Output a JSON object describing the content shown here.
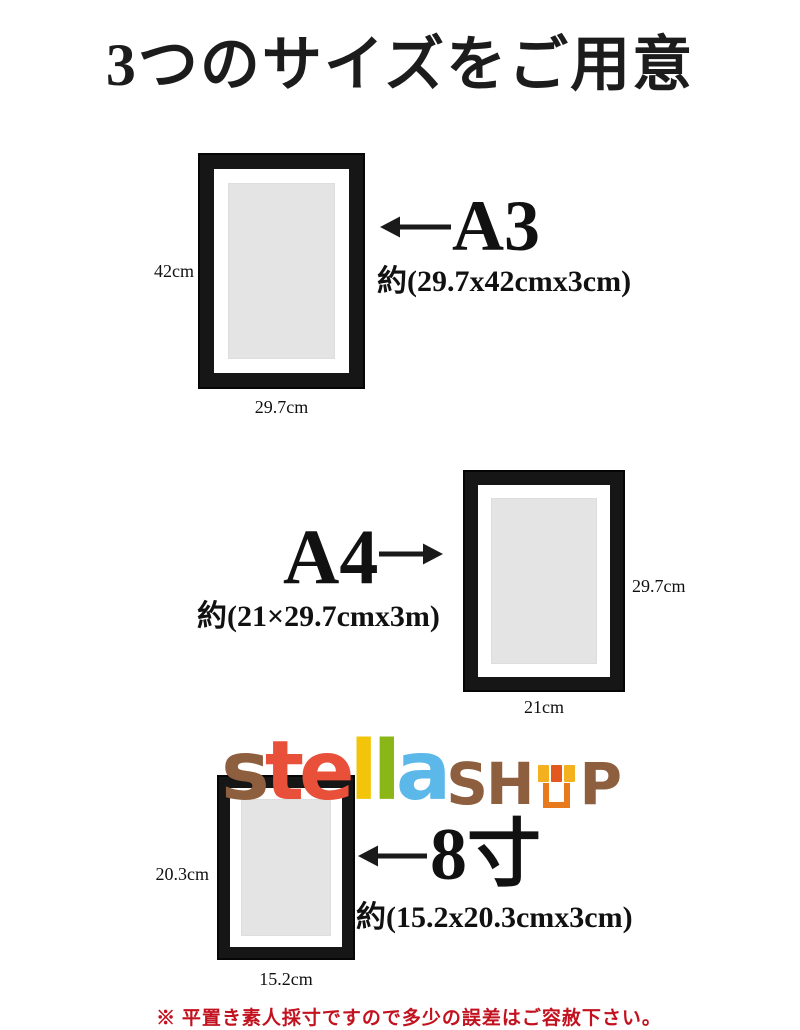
{
  "title": "3つのサイズをご用意",
  "sizes": [
    {
      "id": "a3",
      "name": "A3",
      "approx": "約(29.7x42cmx3cm)",
      "side_label": "42cm",
      "bottom_label": "29.7cm",
      "arrow_direction": "left"
    },
    {
      "id": "a4",
      "name": "A4",
      "approx": "約(21×29.7cmx3m)",
      "side_label": "29.7cm",
      "bottom_label": "21cm",
      "arrow_direction": "right"
    },
    {
      "id": "hassun",
      "name": "8寸",
      "approx": "約(15.2x20.3cmx3cm)",
      "side_label": "20.3cm",
      "bottom_label": "15.2cm",
      "arrow_direction": "left"
    }
  ],
  "logo": {
    "chars": [
      "s",
      "t",
      "e",
      "l",
      "l",
      "a",
      "S",
      "H",
      "P"
    ],
    "icon": "storefront-icon",
    "colors": {
      "brown": "#8d5f3f",
      "red_orange": "#e8503a",
      "yellow": "#f2c40a",
      "green": "#8ab717",
      "blue": "#5bb8e8",
      "awning_amber": "#f3b11f",
      "awning_orange": "#e4571e",
      "store_orange": "#e87a1e"
    }
  },
  "footnote": "※ 平置き素人採寸ですので多少の誤差はご容赦下さい。",
  "colors": {
    "frame_black": "#161616",
    "mat_white": "#ffffff",
    "art_gray": "#e4e4e4",
    "text_black": "#1a1a1a",
    "note_red": "#c3121f"
  }
}
